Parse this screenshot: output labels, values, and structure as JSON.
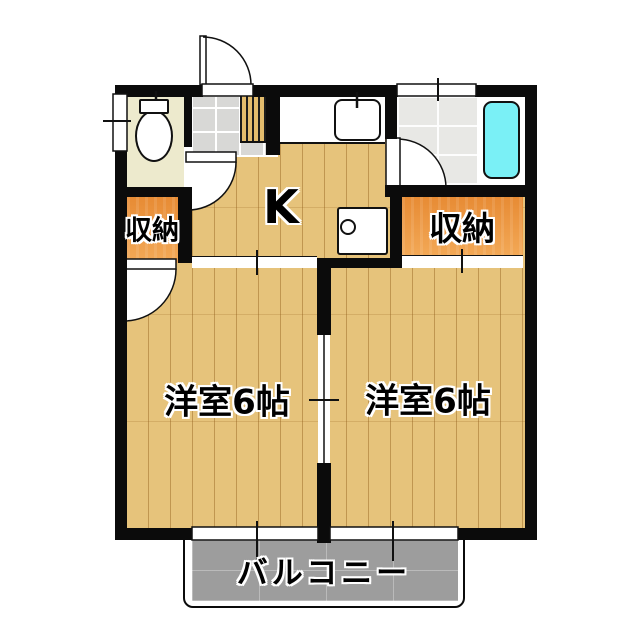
{
  "plan": {
    "rooms": [
      {
        "id": "kitchen",
        "label": "K"
      },
      {
        "id": "closet-left",
        "label": "収納"
      },
      {
        "id": "closet-right",
        "label": "収納"
      },
      {
        "id": "western-room-left",
        "label": "洋室6帖"
      },
      {
        "id": "western-room-right",
        "label": "洋室6帖"
      },
      {
        "id": "balcony",
        "label": "バルコニー"
      }
    ],
    "fixtures": [
      {
        "icon": "toilet-icon"
      },
      {
        "icon": "kitchen-sink-icon"
      },
      {
        "icon": "bathtub-icon"
      },
      {
        "icon": "stove-icon"
      },
      {
        "icon": "entrance-door-icon"
      },
      {
        "icon": "bathroom-door-icon"
      },
      {
        "icon": "toilet-door-icon"
      },
      {
        "icon": "closet-door-icon"
      },
      {
        "icon": "sliding-partition-icon"
      },
      {
        "icon": "window-icon"
      }
    ],
    "colors": {
      "wall": "#0b0b0b",
      "wood_floor": "#e6c37b",
      "closet_orange_top": "#e78b34",
      "closet_orange_bottom": "#f3a957",
      "toilet_room": "#edeacd",
      "bathtub": "#7af0f6",
      "balcony": "#9d9d9d",
      "genkan_tile": "#d8d8d6",
      "bath_tile": "#e8e8e5"
    }
  }
}
